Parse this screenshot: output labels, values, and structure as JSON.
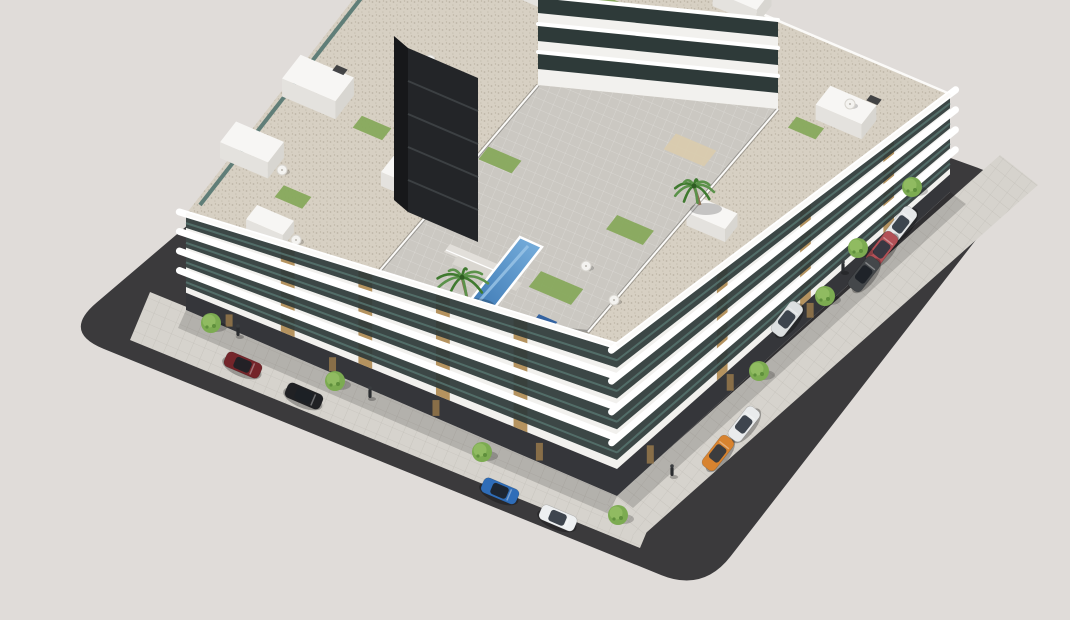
{
  "scene": {
    "type": "3d-architectural-rendering",
    "subject": "Aerial isometric render of a modern white residential apartment complex with curved balconies, rooftop terraces, a central courtyard with swimming pool and palm trees, surrounded by streets with parked cars",
    "palette": {
      "background": "#e0dcd9",
      "plot_asphalt": "#3b3a3c",
      "sidewalk": "#d6d3cd",
      "sidewalk_line": "#a8a49c",
      "facade_white": "#f2f1ee",
      "facade_shade": "#e4e2de",
      "glass_dark": "#2e3a39",
      "glass_teal": "#5a7a74",
      "wood": "#b5935f",
      "wood_dark": "#97784b",
      "ground_floor_dark": "#35363a",
      "core_tower": "#232528",
      "core_tower_side": "#17181a",
      "roof_gravel": "#d7d0c3",
      "gravel_dot": "#bdb5a6",
      "parapet": "#fbfaf8",
      "courtyard_paving": "#cbc8c2",
      "lawn": "#87a95c",
      "sand_patch": "#d9cbae",
      "pool_deep": "#2f6cab",
      "pool_light": "#79b0dd",
      "pool_rim": "#ffffff",
      "plunge_pool": "#2a5d9e",
      "green_roof": "#57683e",
      "green_roof_dot": "#6d8049",
      "canopy_wall": "#3b3a37",
      "palm_frond": "#3f7a2f",
      "palm_frond_light": "#5b924a",
      "palm_trunk": "#8a7054",
      "tree_canopy": "#7cab51",
      "tree_canopy_light": "#92bd63",
      "tree_canopy_dark": "#5f8f3c",
      "shadow": "rgba(0,0,0,0.16)"
    },
    "objects": {
      "cars": [
        {
          "name": "dark-red-sedan",
          "body": "#74252a",
          "street": "left",
          "x": 243,
          "y": 365
        },
        {
          "name": "black-suv",
          "body": "#202124",
          "street": "left",
          "x": 304,
          "y": 396
        },
        {
          "name": "blue-sedan",
          "body": "#2f6db8",
          "street": "left",
          "x": 500,
          "y": 491
        },
        {
          "name": "white-sedan",
          "body": "#eef0f1",
          "street": "left",
          "x": 558,
          "y": 518
        },
        {
          "name": "orange-hatchback",
          "body": "#d8832f",
          "street": "right",
          "x": 718,
          "y": 453
        },
        {
          "name": "white-hatchback",
          "body": "#e9ebec",
          "street": "right",
          "x": 744,
          "y": 424
        },
        {
          "name": "light-gray-car",
          "body": "#dcdfe0",
          "street": "right",
          "x": 787,
          "y": 319
        },
        {
          "name": "silver-car",
          "body": "#e6e8e9",
          "street": "right",
          "x": 901,
          "y": 224
        },
        {
          "name": "red-coupe",
          "body": "#b25056",
          "street": "right",
          "x": 882,
          "y": 249
        },
        {
          "name": "dark-gray-car",
          "body": "#44474a",
          "street": "right",
          "x": 864,
          "y": 274
        }
      ],
      "street_trees": [
        {
          "x": 211,
          "y": 323
        },
        {
          "x": 335,
          "y": 381
        },
        {
          "x": 482,
          "y": 452
        },
        {
          "x": 618,
          "y": 515
        },
        {
          "x": 759,
          "y": 371
        },
        {
          "x": 825,
          "y": 296
        },
        {
          "x": 858,
          "y": 248
        },
        {
          "x": 912,
          "y": 187
        }
      ],
      "pedestrians": [
        {
          "x": 238,
          "y": 336
        },
        {
          "x": 370,
          "y": 398
        },
        {
          "x": 672,
          "y": 476
        },
        {
          "x": 843,
          "y": 272
        }
      ],
      "palms": [
        {
          "x": 468,
          "y": 302,
          "r": 26
        },
        {
          "x": 700,
          "y": 205,
          "r": 20
        },
        {
          "x": 795,
          "y": 266,
          "r": 16
        }
      ],
      "roof_volumes": [
        {
          "x": 252,
          "y": 158,
          "w": 52,
          "d": 26,
          "h": 16
        },
        {
          "x": 318,
          "y": 96,
          "w": 58,
          "d": 30,
          "h": 18
        },
        {
          "x": 408,
          "y": 186,
          "w": 44,
          "d": 22,
          "h": 14
        },
        {
          "x": 540,
          "y": -6,
          "w": 60,
          "d": 26,
          "h": 16
        },
        {
          "x": 664,
          "y": -34,
          "w": 56,
          "d": 24,
          "h": 16
        },
        {
          "x": 742,
          "y": 6,
          "w": 48,
          "d": 24,
          "h": 15
        },
        {
          "x": 846,
          "y": 120,
          "w": 50,
          "d": 24,
          "h": 15
        },
        {
          "x": 270,
          "y": 232,
          "w": 40,
          "d": 18,
          "h": 12
        },
        {
          "x": 712,
          "y": 226,
          "w": 42,
          "d": 20,
          "h": 13
        }
      ],
      "roof_lawns": [
        {
          "x": 293,
          "y": 197,
          "w": 30,
          "d": 15
        },
        {
          "x": 372,
          "y": 128,
          "w": 32,
          "d": 15
        },
        {
          "x": 610,
          "y": 6,
          "w": 34,
          "d": 15
        },
        {
          "x": 806,
          "y": 128,
          "w": 30,
          "d": 14
        }
      ],
      "roof_units": [
        {
          "x": 340,
          "y": 70
        },
        {
          "x": 520,
          "y": -20
        },
        {
          "x": 770,
          "y": 60
        },
        {
          "x": 874,
          "y": 100
        }
      ],
      "roof_umbrellas": [
        {
          "x": 282,
          "y": 170
        },
        {
          "x": 430,
          "y": 60
        },
        {
          "x": 700,
          "y": -16
        },
        {
          "x": 758,
          "y": 82
        },
        {
          "x": 850,
          "y": 104
        },
        {
          "x": 296,
          "y": 240
        }
      ],
      "courtyard_umbrellas": [
        {
          "x": 586,
          "y": 266
        },
        {
          "x": 614,
          "y": 300
        }
      ],
      "courtyard_lawns": [
        {
          "x": 556,
          "y": 288,
          "w": 46,
          "d": 20
        },
        {
          "x": 630,
          "y": 230,
          "w": 40,
          "d": 18
        },
        {
          "x": 500,
          "y": 160,
          "w": 36,
          "d": 16
        }
      ],
      "sand_patches": [
        {
          "x": 690,
          "y": 150,
          "w": 44,
          "d": 20
        }
      ]
    }
  }
}
